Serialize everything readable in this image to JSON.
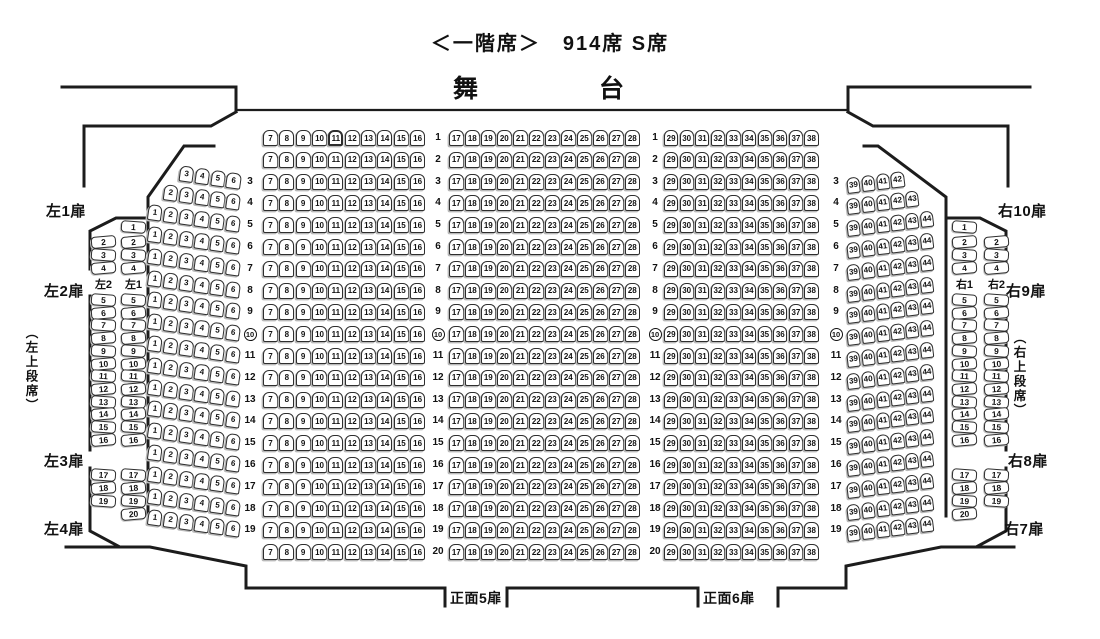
{
  "title": "＜一階席＞　914席 S席",
  "stage": {
    "left_char": "舞",
    "right_char": "台"
  },
  "doors": {
    "left": [
      "左1扉",
      "左2扉",
      "左3扉",
      "左4扉"
    ],
    "right": [
      "右10扉",
      "右9扉",
      "右8扉",
      "右7扉"
    ],
    "front": [
      "正面5扉",
      "正面6扉"
    ]
  },
  "upper_tier_labels": {
    "left": "（左上段席）",
    "right": "（右上段席）"
  },
  "circled_row": 10,
  "emphasized_seat": {
    "block": "center_left",
    "row": 1,
    "seat": 11
  },
  "blocks": {
    "center_left": {
      "row_start": 1,
      "row_end": 20,
      "seat_start": 7,
      "seat_end": 16
    },
    "center": {
      "row_start": 1,
      "row_end": 20,
      "seat_start": 17,
      "seat_end": 28
    },
    "center_right": {
      "row_start": 1,
      "row_end": 20,
      "seat_start": 29,
      "seat_end": 38
    },
    "left_slant": {
      "row_start": 3,
      "row_end": 19,
      "seat_start": 1,
      "seat_end": 6,
      "row_overrides": {
        "3": {
          "seat_start": 3
        },
        "4": {
          "seat_start": 2
        }
      }
    },
    "right_slant": {
      "row_start": 3,
      "row_end": 19,
      "seat_start": 39,
      "seat_end": 44,
      "row_overrides": {
        "3": {
          "seat_end": 42
        },
        "4": {
          "seat_end": 43
        }
      }
    }
  },
  "side_blocks": {
    "left": {
      "columns": [
        {
          "label": "左2",
          "groups": [
            {
              "start": 2,
              "end": 4
            },
            {
              "start": 5,
              "end": 16
            },
            {
              "start": 17,
              "end": 19
            }
          ]
        },
        {
          "label": "左1",
          "groups": [
            {
              "start": 1,
              "end": 4
            },
            {
              "start": 5,
              "end": 16
            },
            {
              "start": 17,
              "end": 20
            }
          ]
        }
      ]
    },
    "right": {
      "columns": [
        {
          "label": "右1",
          "groups": [
            {
              "start": 1,
              "end": 4
            },
            {
              "start": 5,
              "end": 16
            },
            {
              "start": 17,
              "end": 20
            }
          ]
        },
        {
          "label": "右2",
          "groups": [
            {
              "start": 2,
              "end": 4
            },
            {
              "start": 5,
              "end": 16
            },
            {
              "start": 17,
              "end": 19
            }
          ]
        }
      ]
    }
  },
  "row_label_columns": [
    {
      "row_start": 3,
      "row_end": 19
    },
    {
      "row_start": 1,
      "row_end": 20
    },
    {
      "row_start": 1,
      "row_end": 20
    },
    {
      "row_start": 3,
      "row_end": 19
    }
  ]
}
